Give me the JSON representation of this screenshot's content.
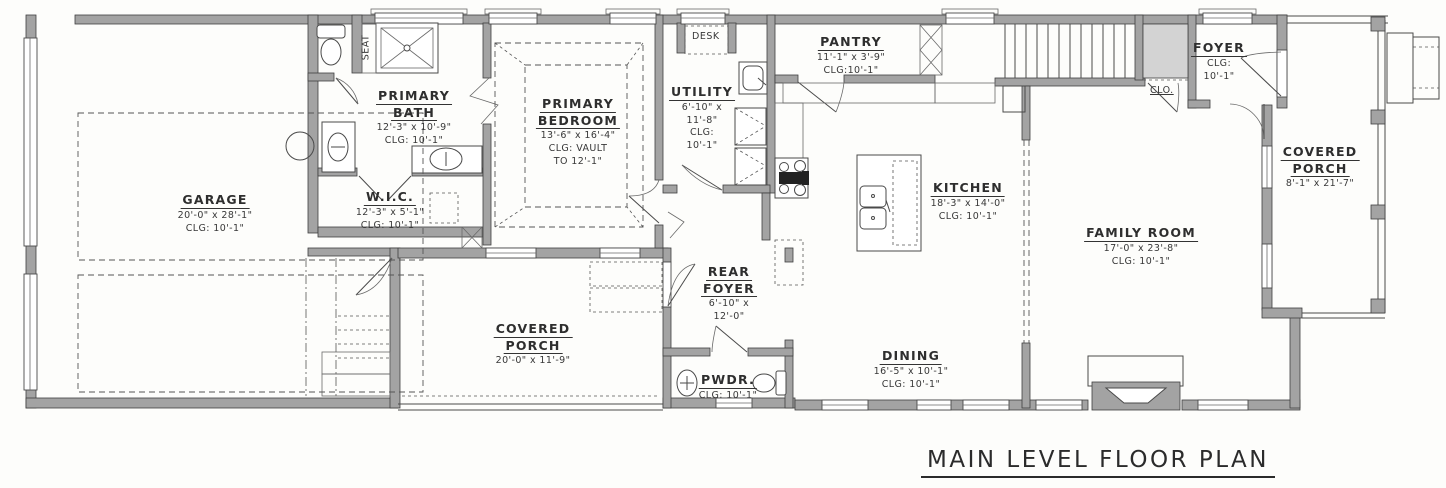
{
  "title": "MAIN LEVEL FLOOR PLAN",
  "colors": {
    "wall": "#a3a3a3",
    "line": "#4a4a4a",
    "text": "#333333",
    "closet_fill": "#d3d3d3"
  },
  "rooms": {
    "garage": {
      "name": "GARAGE",
      "dims": "20'-0\" x 28'-1\"",
      "clg": "CLG: 10'-1\""
    },
    "primary_bath": {
      "name1": "PRIMARY",
      "name2": "BATH",
      "dims": "12'-3\" x 10'-9\"",
      "clg": "CLG: 10'-1\""
    },
    "wic": {
      "name": "W.I.C.",
      "dims": "12'-3\" x 5'-1\"",
      "clg": "CLG: 10'-1\""
    },
    "primary_bedroom": {
      "name1": "PRIMARY",
      "name2": "BEDROOM",
      "dims": "13'-6\" x 16'-4\"",
      "clg1": "CLG: VAULT",
      "clg2": "TO 12'-1\""
    },
    "utility": {
      "name": "UTILITY",
      "dims1": "6'-10\" x",
      "dims2": "11'-8\"",
      "clg1": "CLG:",
      "clg2": "10'-1\""
    },
    "pantry": {
      "name": "PANTRY",
      "dims": "11'-1\" x 3'-9\"",
      "clg": "CLG:10'-1\""
    },
    "kitchen": {
      "name": "KITCHEN",
      "dims": "18'-3\" x 14'-0\"",
      "clg": "CLG: 10'-1\""
    },
    "family_room": {
      "name": "FAMILY ROOM",
      "dims": "17'-0\" x 23'-8\"",
      "clg": "CLG: 10'-1\""
    },
    "foyer": {
      "name": "FOYER",
      "clg1": "CLG:",
      "clg2": "10'-1\""
    },
    "covered_porch_right": {
      "name1": "COVERED",
      "name2": "PORCH",
      "dims": "8'-1\" x 21'-7\""
    },
    "rear_foyer": {
      "name1": "REAR",
      "name2": "FOYER",
      "dims1": "6'-10\" x",
      "dims2": "12'-0\""
    },
    "covered_porch_rear": {
      "name1": "COVERED",
      "name2": "PORCH",
      "dims": "20'-0\" x 11'-9\""
    },
    "pwdr": {
      "name": "PWDR.",
      "clg": "CLG: 10'-1\""
    },
    "dining": {
      "name": "DINING",
      "dims": "16'-5\" x 10'-1\"",
      "clg": "CLG: 10'-1\""
    }
  },
  "annotations": {
    "seat": "SEAT",
    "desk": "DESK",
    "clo": "CLO."
  }
}
